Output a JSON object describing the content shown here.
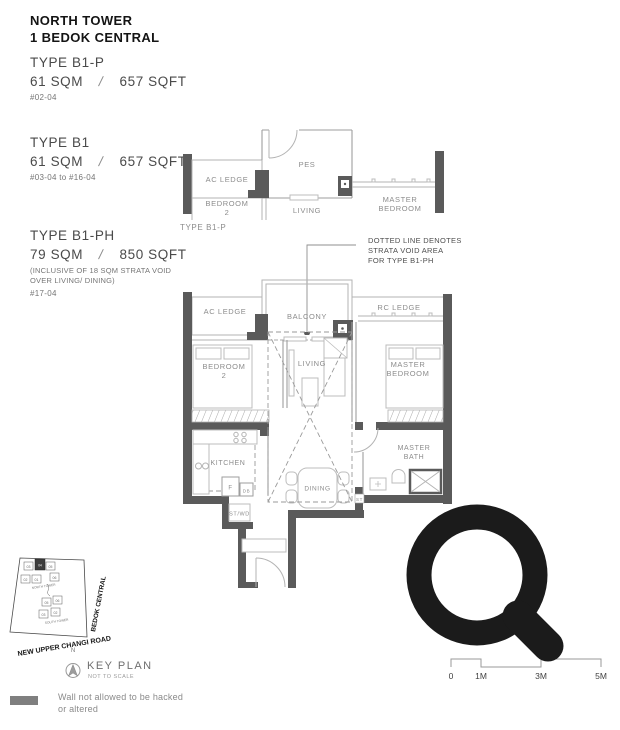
{
  "header": {
    "line1": "NORTH TOWER",
    "line2": "1 BEDOK CENTRAL"
  },
  "types": {
    "b1p": {
      "name": "TYPE B1-P",
      "sqm": "61 SQM",
      "slash": "/",
      "sqft": "657 SQFT",
      "units": "#02-04"
    },
    "b1": {
      "name": "TYPE B1",
      "sqm": "61 SQM",
      "slash": "/",
      "sqft": "657 SQFT",
      "units": "#03-04 to #16-04"
    },
    "b1ph": {
      "name": "TYPE B1-PH",
      "sqm": "79 SQM",
      "slash": "/",
      "sqft": "850 SQFT",
      "note_l1": "(INCLUSIVE OF 18 SQM STRATA VOID",
      "note_l2": "OVER LIVING/ DINING)",
      "units": "#17-04"
    }
  },
  "top_plan": {
    "caption": "TYPE B1-P",
    "labels": {
      "ac_ledge": "AC LEDGE",
      "pes": "PES",
      "bedroom2_l1": "BEDROOM",
      "bedroom2_l2": "2",
      "living": "LIVING",
      "master_l1": "MASTER",
      "master_l2": "BEDROOM"
    }
  },
  "annotation": {
    "l1": "DOTTED LINE DENOTES",
    "l2": "STRATA VOID AREA",
    "l3": "FOR TYPE B1-PH"
  },
  "main_plan": {
    "labels": {
      "balcony": "BALCONY",
      "ac_ledge": "AC LEDGE",
      "rc_ledge": "RC LEDGE",
      "bedroom2_l1": "BEDROOM",
      "bedroom2_l2": "2",
      "living": "LIVING",
      "master_l1": "MASTER",
      "master_l2": "BEDROOM",
      "kitchen": "KITCHEN",
      "dining": "DINING",
      "f": "F",
      "db": "DB",
      "st": "ST",
      "st_wd": "ST/WD",
      "master_bath_l1": "MASTER",
      "master_bath_l2": "BATH"
    }
  },
  "key_plan": {
    "title": "KEY PLAN",
    "subtitle": "NOT TO SCALE",
    "north": "N",
    "road_bedok": "BEDOK CENTRAL",
    "road_changi": "NEW UPPER CHANGI ROAD",
    "north_tower": "NORTH TOWER",
    "south_tower": "SOUTH TOWER",
    "units_north": [
      "03",
      "04",
      "05",
      "02",
      "01",
      "06"
    ],
    "units_south": [
      "06",
      "05",
      "03",
      "02"
    ]
  },
  "legend": {
    "l1": "Wall not allowed to be hacked",
    "l2": "or altered",
    "swatch_style": "background:#7f7f7f"
  },
  "scale_bar": {
    "labels": [
      "0",
      "1M",
      "3M",
      "5M"
    ]
  },
  "colors": {
    "wall": "#5a5a5a",
    "thin_line": "#b3b3b3",
    "room_label": "#8c8c8c",
    "text_dark": "#141414",
    "text_gray": "#4f4f4f",
    "magnifier": "#1b1b1b"
  }
}
